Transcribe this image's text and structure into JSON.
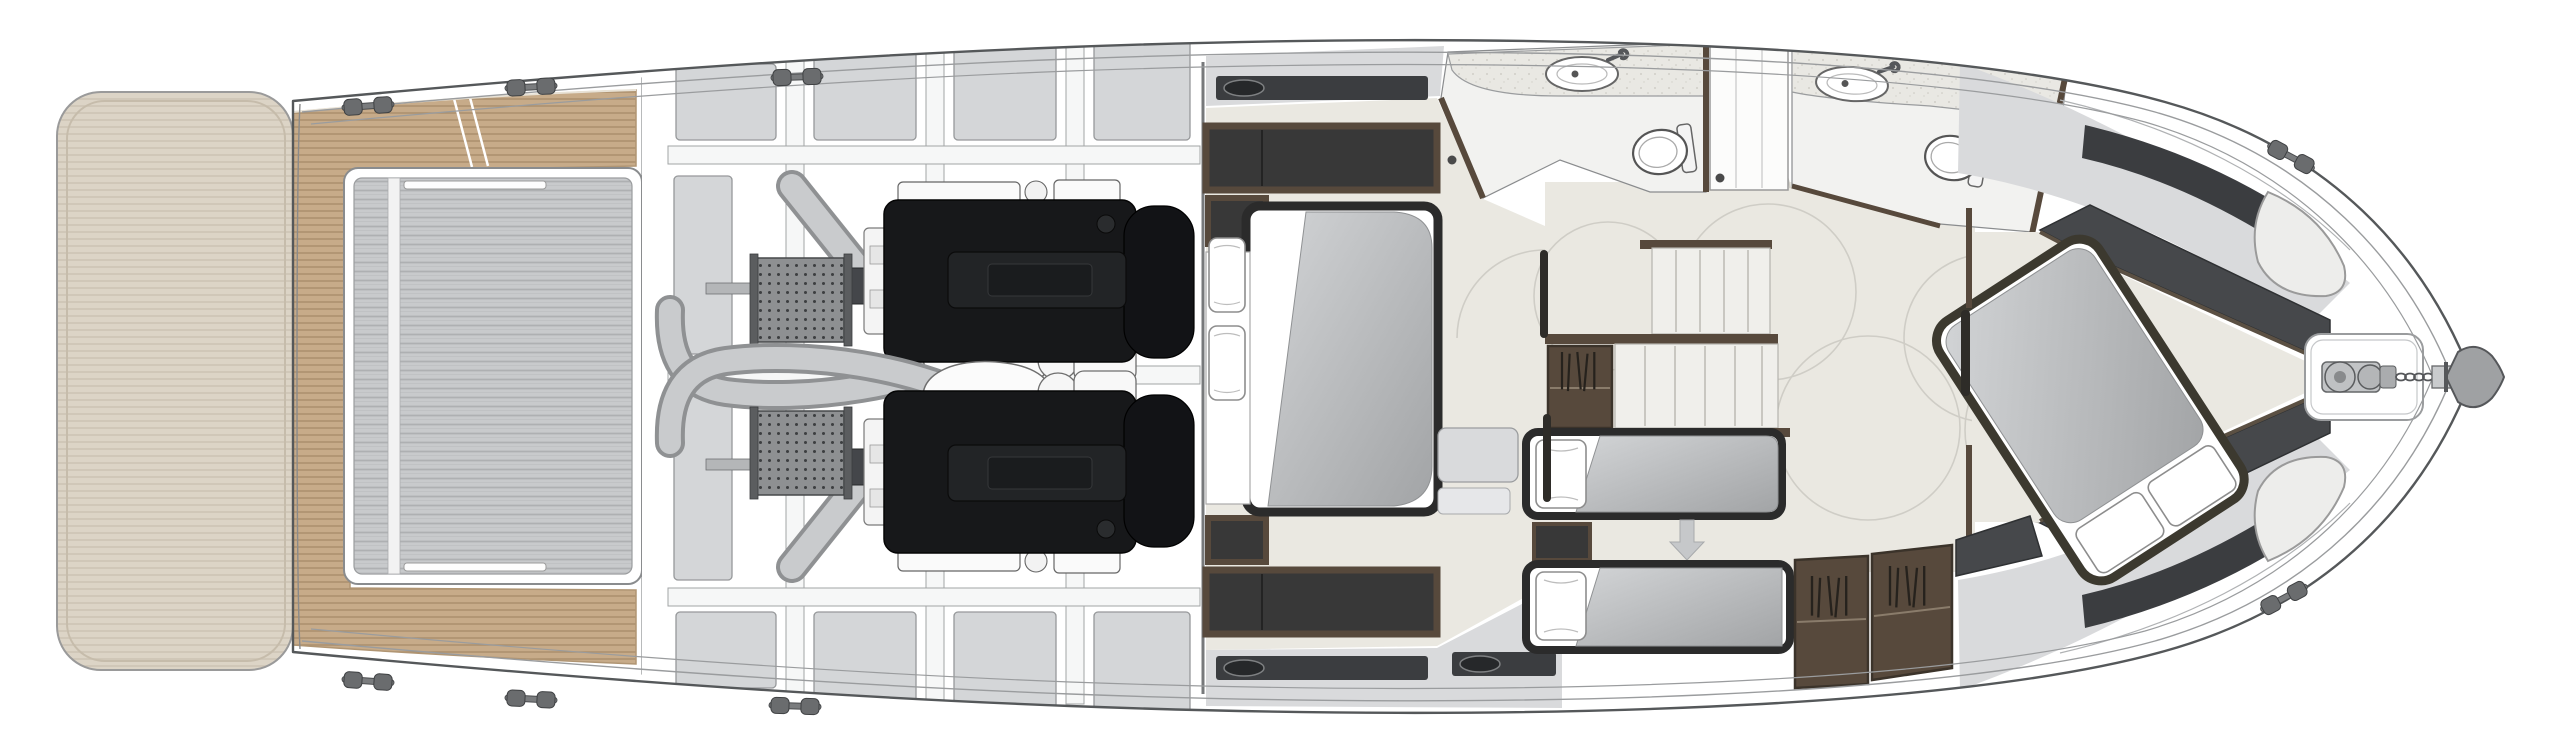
{
  "meta": {
    "view": "yacht-lower-deck-floor-plan",
    "canvas_width": 2560,
    "canvas_height": 753
  },
  "colors": {
    "hull_fill": "#ffffff",
    "hull_line": "#55585a",
    "inner_line": "#9a9c9e",
    "platform": "#dcd4c6",
    "platform_line": "#cdc4b4",
    "teak": "#c7ab89",
    "teak_line": "#a98e6b",
    "hatch": "#c8cacc",
    "hatch_line": "#aeb0b2",
    "panel": "#d4d6d8",
    "panel_line": "#96989a",
    "beam": "#f6f7f7",
    "engine": "#17181a",
    "engine_plate": "#222426",
    "pipe": "#c9cbcd",
    "pipe_edge": "#8f9193",
    "cooler": "#8e9092",
    "shaft": "#b4b6b8",
    "floor": "#eae8e1",
    "bath_floor": "#f2f2f0",
    "counter": "#e9e8e3",
    "furn_brown": "#57493c",
    "furn_dark": "#383838",
    "bed_frame": "#2b2b2b",
    "mattress_hi": "#d2d4d6",
    "mattress_lo": "#a2a4a6",
    "window": "#3b3d40",
    "sidedeck": "#d9dadc",
    "charcoal": "#46484b",
    "white": "#ffffff",
    "arrow": "#c6c8ca",
    "metal": "#c2c4c6",
    "anchor": "#9fa1a3",
    "arc": "#cfcdc6",
    "wall_line": "#8a8c8e"
  },
  "vessel": {
    "areas": [
      {
        "name": "swim-platform"
      },
      {
        "name": "cockpit-teak-deck"
      },
      {
        "name": "tender-garage-hatch"
      },
      {
        "name": "engine-room",
        "engines": 2,
        "coolers": 2,
        "prop_shafts": 2
      },
      {
        "name": "master-cabin",
        "beds": 1,
        "pillows": 2,
        "hull_windows": 4
      },
      {
        "name": "aft-head",
        "sinks": 1,
        "toilets": 1
      },
      {
        "name": "shower"
      },
      {
        "name": "forward-head",
        "sinks": 1,
        "toilets": 1
      },
      {
        "name": "staircase",
        "runs": 2
      },
      {
        "name": "guest-cabin",
        "berths": 2,
        "pillows": 2,
        "slide_arrow": 1
      },
      {
        "name": "wardrobes",
        "count": 4
      },
      {
        "name": "vip-cabin",
        "beds": 1,
        "pillows": 2,
        "hull_windows": 2
      },
      {
        "name": "foredeck",
        "windlass": 1,
        "anchor": 1,
        "deck_hatches": 2
      }
    ],
    "cleats": 8
  }
}
